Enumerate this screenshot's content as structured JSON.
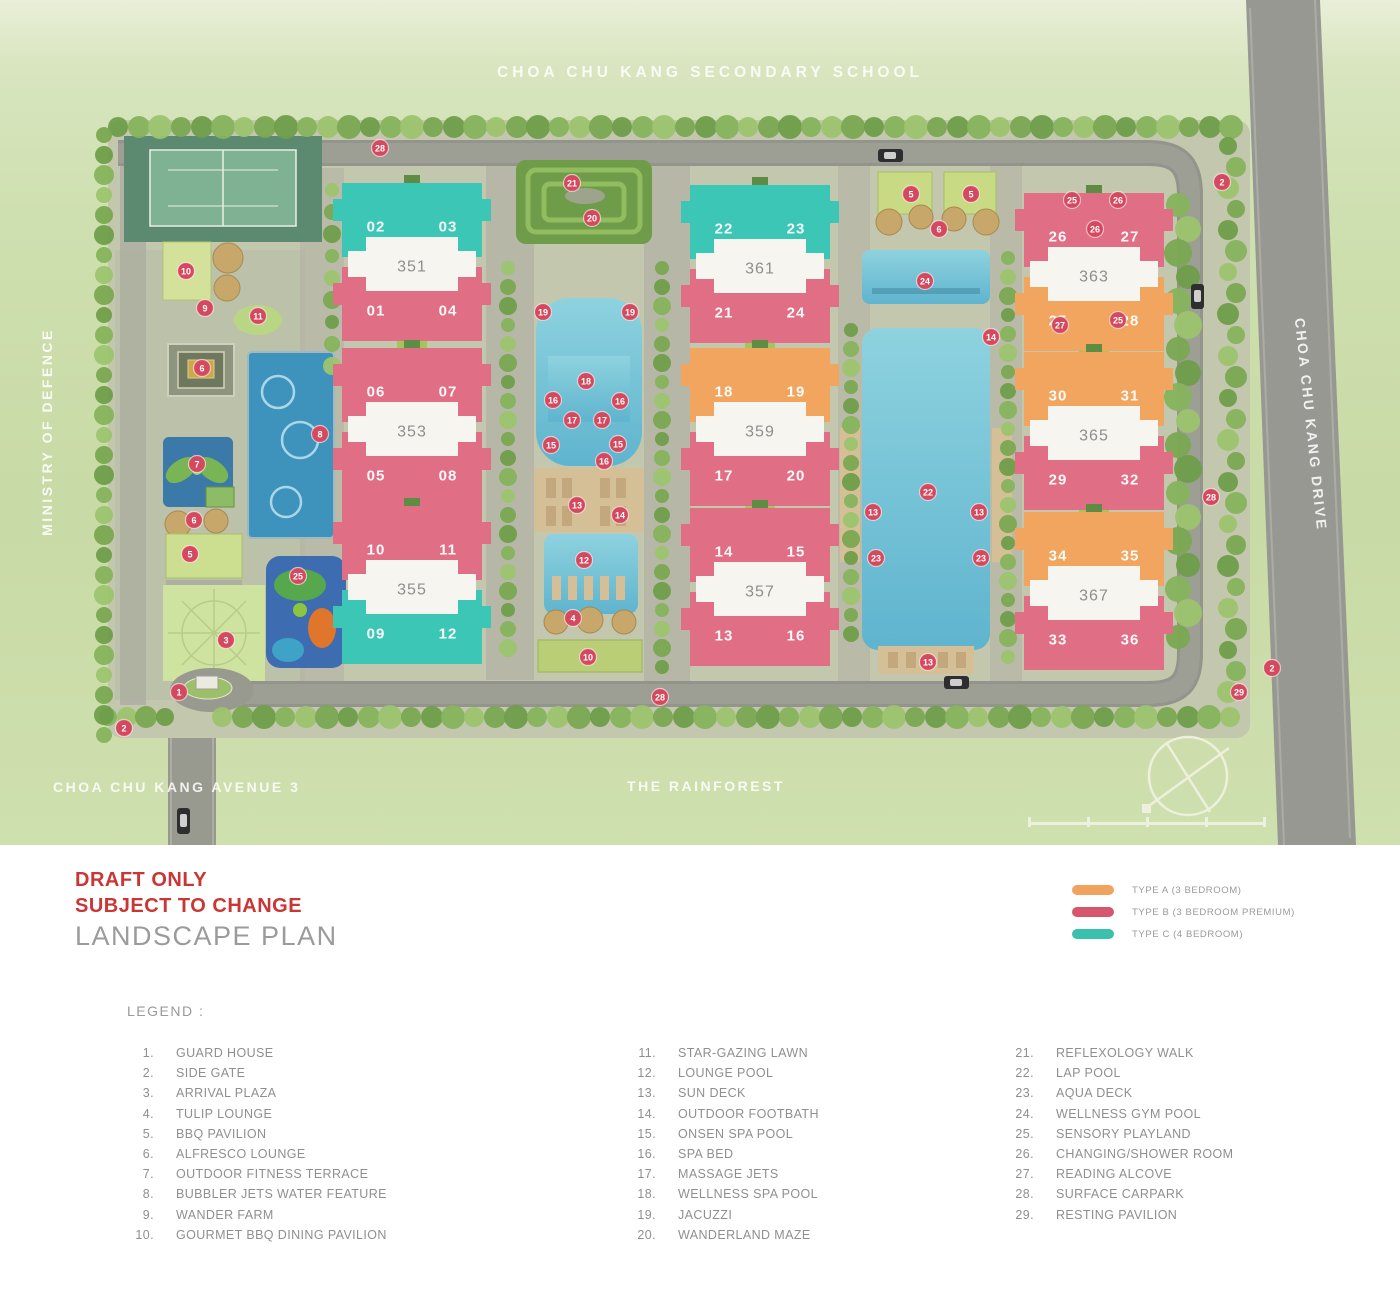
{
  "plan": {
    "surroundings": {
      "top_label": "CHOA CHU KANG SECONDARY SCHOOL",
      "left_label": "MINISTRY OF DEFENCE",
      "right_road_label": "CHOA CHU KANG DRIVE",
      "bottom_left_road_label": "CHOA CHU KANG AVENUE 3",
      "bottom_center_label": "THE RAINFOREST"
    },
    "unit_type_colors": {
      "A": "#f2a55e",
      "B": "#e06e85",
      "C": "#3cc6b6"
    },
    "marker_color": "#d5495e",
    "blocks": [
      {
        "col": 0,
        "row": 0,
        "label": "351",
        "top": {
          "type": "C",
          "units": [
            "02",
            "03"
          ]
        },
        "bottom": {
          "type": "B",
          "units": [
            "01",
            "04"
          ]
        }
      },
      {
        "col": 0,
        "row": 1,
        "label": "353",
        "top": {
          "type": "B",
          "units": [
            "06",
            "07"
          ]
        },
        "bottom": {
          "type": "B",
          "units": [
            "05",
            "08"
          ]
        }
      },
      {
        "col": 0,
        "row": 2,
        "label": "355",
        "top": {
          "type": "B",
          "units": [
            "10",
            "11"
          ]
        },
        "bottom": {
          "type": "C",
          "units": [
            "09",
            "12"
          ]
        }
      },
      {
        "col": 1,
        "row": 0,
        "label": "361",
        "top": {
          "type": "C",
          "units": [
            "22",
            "23"
          ]
        },
        "bottom": {
          "type": "B",
          "units": [
            "21",
            "24"
          ]
        }
      },
      {
        "col": 1,
        "row": 1,
        "label": "359",
        "top": {
          "type": "A",
          "units": [
            "18",
            "19"
          ]
        },
        "bottom": {
          "type": "B",
          "units": [
            "17",
            "20"
          ]
        }
      },
      {
        "col": 1,
        "row": 2,
        "label": "357",
        "top": {
          "type": "B",
          "units": [
            "14",
            "15"
          ]
        },
        "bottom": {
          "type": "B",
          "units": [
            "13",
            "16"
          ]
        }
      },
      {
        "col": 2,
        "row": 0,
        "label": "363",
        "top": {
          "type": "B",
          "units": [
            "26",
            "27"
          ]
        },
        "bottom": {
          "type": "A",
          "units": [
            "25",
            "28"
          ]
        }
      },
      {
        "col": 2,
        "row": 1,
        "label": "365",
        "top": {
          "type": "A",
          "units": [
            "30",
            "31"
          ]
        },
        "bottom": {
          "type": "B",
          "units": [
            "29",
            "32"
          ]
        }
      },
      {
        "col": 2,
        "row": 2,
        "label": "367",
        "top": {
          "type": "A",
          "units": [
            "34",
            "35"
          ]
        },
        "bottom": {
          "type": "B",
          "units": [
            "33",
            "36"
          ]
        }
      }
    ],
    "markers": [
      {
        "n": "28",
        "x": 380,
        "y": 148
      },
      {
        "n": "2",
        "x": 1222,
        "y": 182
      },
      {
        "n": "21",
        "x": 572,
        "y": 183
      },
      {
        "n": "20",
        "x": 592,
        "y": 218
      },
      {
        "n": "10",
        "x": 186,
        "y": 271
      },
      {
        "n": "9",
        "x": 205,
        "y": 308
      },
      {
        "n": "11",
        "x": 258,
        "y": 316
      },
      {
        "n": "6",
        "x": 202,
        "y": 368
      },
      {
        "n": "8",
        "x": 320,
        "y": 434
      },
      {
        "n": "7",
        "x": 197,
        "y": 464
      },
      {
        "n": "6",
        "x": 194,
        "y": 520
      },
      {
        "n": "5",
        "x": 190,
        "y": 554
      },
      {
        "n": "25",
        "x": 298,
        "y": 576
      },
      {
        "n": "3",
        "x": 226,
        "y": 640
      },
      {
        "n": "1",
        "x": 179,
        "y": 692
      },
      {
        "n": "2",
        "x": 124,
        "y": 728
      },
      {
        "n": "19",
        "x": 543,
        "y": 312
      },
      {
        "n": "19",
        "x": 630,
        "y": 312
      },
      {
        "n": "18",
        "x": 586,
        "y": 381
      },
      {
        "n": "16",
        "x": 553,
        "y": 400
      },
      {
        "n": "16",
        "x": 620,
        "y": 401
      },
      {
        "n": "17",
        "x": 572,
        "y": 420
      },
      {
        "n": "17",
        "x": 602,
        "y": 420
      },
      {
        "n": "15",
        "x": 551,
        "y": 445
      },
      {
        "n": "15",
        "x": 618,
        "y": 444
      },
      {
        "n": "16",
        "x": 604,
        "y": 461
      },
      {
        "n": "13",
        "x": 577,
        "y": 505
      },
      {
        "n": "14",
        "x": 620,
        "y": 515
      },
      {
        "n": "12",
        "x": 584,
        "y": 560
      },
      {
        "n": "4",
        "x": 573,
        "y": 618
      },
      {
        "n": "10",
        "x": 588,
        "y": 657
      },
      {
        "n": "5",
        "x": 911,
        "y": 194
      },
      {
        "n": "5",
        "x": 971,
        "y": 194
      },
      {
        "n": "6",
        "x": 939,
        "y": 229
      },
      {
        "n": "24",
        "x": 925,
        "y": 281
      },
      {
        "n": "14",
        "x": 991,
        "y": 337
      },
      {
        "n": "22",
        "x": 928,
        "y": 492
      },
      {
        "n": "13",
        "x": 873,
        "y": 512
      },
      {
        "n": "13",
        "x": 979,
        "y": 512
      },
      {
        "n": "23",
        "x": 876,
        "y": 558
      },
      {
        "n": "23",
        "x": 981,
        "y": 558
      },
      {
        "n": "13",
        "x": 928,
        "y": 662
      },
      {
        "n": "25",
        "x": 1072,
        "y": 200
      },
      {
        "n": "26",
        "x": 1118,
        "y": 200
      },
      {
        "n": "26",
        "x": 1095,
        "y": 229
      },
      {
        "n": "27",
        "x": 1060,
        "y": 325
      },
      {
        "n": "25",
        "x": 1118,
        "y": 320
      },
      {
        "n": "28",
        "x": 1211,
        "y": 497
      },
      {
        "n": "2",
        "x": 1272,
        "y": 668
      },
      {
        "n": "29",
        "x": 1239,
        "y": 692
      },
      {
        "n": "28",
        "x": 660,
        "y": 697
      }
    ]
  },
  "panel": {
    "draft_line1": "DRAFT ONLY",
    "draft_line2": "SUBJECT TO CHANGE",
    "title": "LANDSCAPE PLAN",
    "types": [
      {
        "label": "TYPE A (3 BEDROOM)",
        "color": "#f0a35e"
      },
      {
        "label": "TYPE B (3 BEDROOM PREMIUM)",
        "color": "#d6576d"
      },
      {
        "label": "TYPE C (4 BEDROOM)",
        "color": "#3ac1ae"
      }
    ],
    "legend_title": "LEGEND :",
    "legend_columns": [
      [
        {
          "n": "1.",
          "label": "GUARD HOUSE"
        },
        {
          "n": "2.",
          "label": "SIDE GATE"
        },
        {
          "n": "3.",
          "label": "ARRIVAL PLAZA"
        },
        {
          "n": "4.",
          "label": "TULIP LOUNGE"
        },
        {
          "n": "5.",
          "label": "BBQ PAVILION"
        },
        {
          "n": "6.",
          "label": "ALFRESCO LOUNGE"
        },
        {
          "n": "7.",
          "label": "OUTDOOR FITNESS TERRACE"
        },
        {
          "n": "8.",
          "label": "BUBBLER JETS WATER FEATURE"
        },
        {
          "n": "9.",
          "label": "WANDER FARM"
        },
        {
          "n": "10.",
          "label": "GOURMET BBQ DINING PAVILION"
        }
      ],
      [
        {
          "n": "11.",
          "label": "STAR-GAZING LAWN"
        },
        {
          "n": "12.",
          "label": "LOUNGE POOL"
        },
        {
          "n": "13.",
          "label": "SUN DECK"
        },
        {
          "n": "14.",
          "label": "OUTDOOR FOOTBATH"
        },
        {
          "n": "15.",
          "label": "ONSEN SPA POOL"
        },
        {
          "n": "16.",
          "label": "SPA BED"
        },
        {
          "n": "17.",
          "label": "MASSAGE JETS"
        },
        {
          "n": "18.",
          "label": "WELLNESS SPA POOL"
        },
        {
          "n": "19.",
          "label": "JACUZZI"
        },
        {
          "n": "20.",
          "label": "WANDERLAND MAZE"
        }
      ],
      [
        {
          "n": "21.",
          "label": "REFLEXOLOGY WALK"
        },
        {
          "n": "22.",
          "label": "LAP POOL"
        },
        {
          "n": "23.",
          "label": "AQUA DECK"
        },
        {
          "n": "24.",
          "label": "WELLNESS GYM POOL"
        },
        {
          "n": "25.",
          "label": "SENSORY PLAYLAND"
        },
        {
          "n": "26.",
          "label": "CHANGING/SHOWER ROOM"
        },
        {
          "n": "27.",
          "label": "READING ALCOVE"
        },
        {
          "n": "28.",
          "label": "SURFACE CARPARK"
        },
        {
          "n": "29.",
          "label": "RESTING PAVILION"
        }
      ]
    ]
  }
}
